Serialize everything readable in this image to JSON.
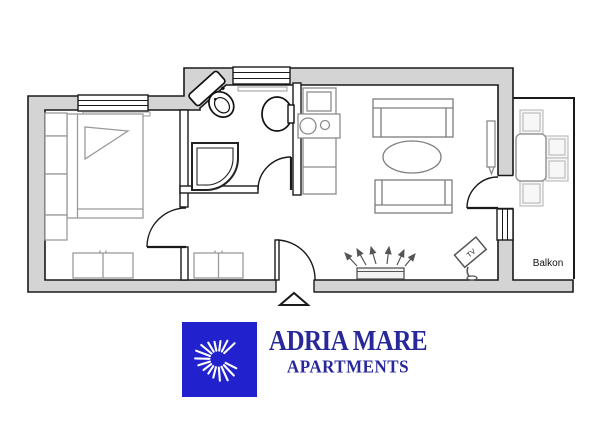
{
  "brand": {
    "title": "ADRIA MARE",
    "subtitle": "APARTMENTS",
    "icon": "sun-swirl-icon",
    "colors": {
      "logo_bg": "#2121cd",
      "text": "#28289b"
    }
  },
  "floorplan": {
    "balcony_label": "Balkon",
    "tv_label": "TV",
    "rooms": [
      "bedroom",
      "bathroom",
      "kitchen",
      "living-room",
      "hallway",
      "balcony"
    ],
    "furniture": [
      "double-bed",
      "wardrobe-column",
      "bedroom-cabinet",
      "hall-cabinet",
      "shower",
      "toilet",
      "sink",
      "kitchen-counter",
      "stove",
      "sofa-top",
      "sofa-bottom",
      "coffee-table",
      "radiator",
      "tv-stand",
      "wall-radiator",
      "balcony-table",
      "balcony-chairs"
    ],
    "colors": {
      "wall_fill": "#d4d4d4",
      "outline": "#1a1a1a",
      "furniture": "#8c8c8c",
      "balcony_furniture": "#c2c2c2"
    }
  }
}
